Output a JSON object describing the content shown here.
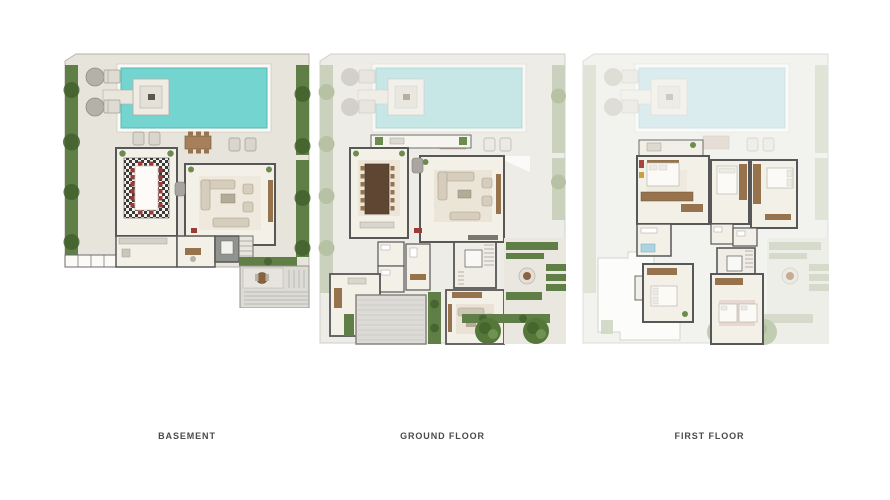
{
  "page": {
    "background": "#ffffff"
  },
  "plans": [
    {
      "id": "basement",
      "label": "BASEMENT"
    },
    {
      "id": "ground-floor",
      "label": "GROUND FLOOR"
    },
    {
      "id": "first-floor",
      "label": "FIRST FLOOR"
    }
  ],
  "palette": {
    "pool": "#74d5d0",
    "pool_faded": "#c7e6e6",
    "pool_ghost": "#dbecef",
    "hedge": "#5f7f47",
    "bush": "#42602e",
    "hedge_faded": "#cad1bc",
    "hedge_ghost": "#dfe4d7",
    "paving": "#e7e4dc",
    "paving_faded": "#eeece7",
    "paving_ghost": "#f2f3ef",
    "room_floor": "#f3f0e8",
    "wall": "#575757",
    "wood": "#96724d",
    "chair_red": "#9c3a38",
    "label_text": "#4a4a4a"
  }
}
